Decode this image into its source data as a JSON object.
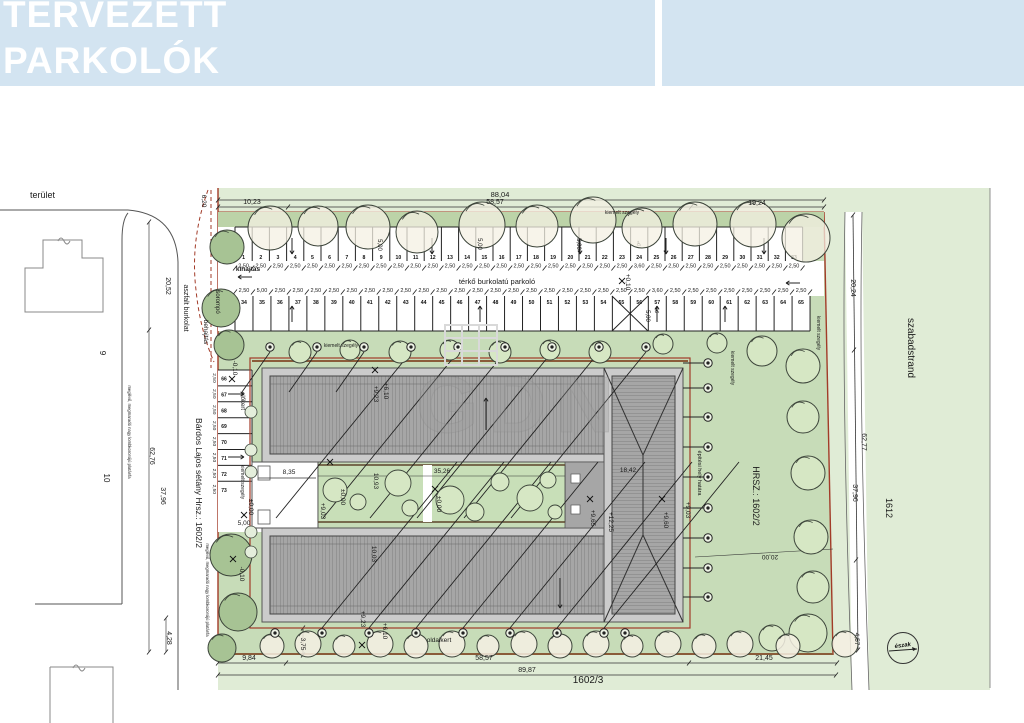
{
  "header": {
    "line1": "TERVEZETT",
    "line2": "PARKOLÓK",
    "bg_color": "#d3e4f1",
    "text_color": "#ffffff"
  },
  "watermark": {
    "text": "GDN"
  },
  "colors": {
    "site_green": "#c7dcb8",
    "strip_green": "#bcd3a8",
    "beach_green": "#e0ecd6",
    "tree_light": "#d6e7c4",
    "tree_cream": "#f4f0e3",
    "tree_dark": "#a7c394",
    "roof_gray": "#a6a6a6",
    "roof_light": "#cbcbcb",
    "hatch": "#6f6f6f",
    "boundary_red": "#a23b28",
    "curb_brown": "#8a5c3a",
    "line_dark": "#222222",
    "building_outline": "#888888"
  },
  "parking": {
    "aisle_label": "térkő burkolatú parkoló",
    "exit_label": "kihajtás",
    "entry_label": "behajtás",
    "gate_label": "sorompó",
    "top_row": {
      "numbers": [
        "1",
        "2",
        "3",
        "4",
        "5",
        "6",
        "7",
        "8",
        "9",
        "10",
        "11",
        "12",
        "13",
        "14",
        "15",
        "16",
        "17",
        "18",
        "19",
        "20",
        "21",
        "22",
        "23",
        "24",
        "25",
        "26",
        "27",
        "28",
        "29",
        "30",
        "31",
        "32",
        "33"
      ],
      "dims": [
        "2,50",
        "2,50",
        "2,50",
        "2,50",
        "2,50",
        "2,50",
        "2,50",
        "2,50",
        "2,50",
        "2,50",
        "2,50",
        "2,50",
        "2,50",
        "2,50",
        "2,50",
        "2,50",
        "2,50",
        "2,50",
        "2,50",
        "2,50",
        "2,50",
        "2,50",
        "2,50",
        "3,60",
        "2,50",
        "2,50",
        "2,50",
        "2,50",
        "2,50",
        "2,50",
        "2,50",
        "2,50",
        "2,50"
      ]
    },
    "bottom_row": {
      "numbers": [
        "34",
        "35",
        "36",
        "37",
        "38",
        "39",
        "40",
        "41",
        "42",
        "43",
        "44",
        "45",
        "46",
        "47",
        "48",
        "49",
        "50",
        "51",
        "52",
        "53",
        "54",
        "55",
        "56",
        "57",
        "58",
        "59",
        "60",
        "61",
        "62",
        "63",
        "64",
        "65"
      ],
      "dims": [
        "2,50",
        "5,00",
        "2,50",
        "2,50",
        "2,50",
        "2,50",
        "2,50",
        "2,50",
        "2,50",
        "2,50",
        "2,50",
        "2,50",
        "2,50",
        "2,50",
        "2,50",
        "2,50",
        "2,50",
        "2,50",
        "2,50",
        "2,50",
        "2,50",
        "2,50",
        "2,50",
        "3,60",
        "2,50",
        "2,50",
        "2,50",
        "2,50",
        "2,50",
        "2,50",
        "2,50",
        "2,50"
      ]
    },
    "left_col": {
      "numbers": [
        "66",
        "67",
        "68",
        "69",
        "70",
        "71",
        "72",
        "73"
      ],
      "dims": [
        "2,50",
        "2,50",
        "2,50",
        "2,50",
        "2,50",
        "2,50",
        "2,50",
        "2,50"
      ]
    }
  },
  "annotations": [
    {
      "t": "terület",
      "x": 30,
      "y": 198,
      "r": 0,
      "s": 9,
      "a": "start"
    },
    {
      "t": "6,20",
      "x": 202,
      "y": 201,
      "r": 90,
      "s": 6.5
    },
    {
      "t": "10,23",
      "x": 252,
      "y": 204,
      "r": 0,
      "s": 7
    },
    {
      "t": "88,04",
      "x": 500,
      "y": 197,
      "r": 0,
      "s": 7.5
    },
    {
      "t": "58,57",
      "x": 495,
      "y": 204,
      "r": 0,
      "s": 7
    },
    {
      "t": "19,24",
      "x": 757,
      "y": 205,
      "r": 0,
      "s": 7
    },
    {
      "t": "kiemelt szegély",
      "x": 622,
      "y": 214,
      "r": 0,
      "s": 5
    },
    {
      "t": "kihajtás",
      "x": 248,
      "y": 271,
      "r": 0,
      "s": 6.5,
      "b": 1
    },
    {
      "t": "térkő burkolatú parkoló",
      "x": 497,
      "y": 284,
      "r": 0,
      "s": 7.5
    },
    {
      "t": "sorompó",
      "x": 216,
      "y": 302,
      "r": 90,
      "s": 6
    },
    {
      "t": "behajtás",
      "x": 204,
      "y": 332,
      "r": 90,
      "s": 6.5
    },
    {
      "t": "aszfalt burkolat",
      "x": 184,
      "y": 308,
      "r": 90,
      "s": 7
    },
    {
      "t": "20,52",
      "x": 166,
      "y": 286,
      "r": 90,
      "s": 7
    },
    {
      "t": "62,76",
      "x": 150,
      "y": 456,
      "r": 90,
      "s": 7
    },
    {
      "t": "37,96",
      "x": 161,
      "y": 496,
      "r": 90,
      "s": 7
    },
    {
      "t": "Bárdos Lajos sétány Hrsz.: 1602/2",
      "x": 196,
      "y": 483,
      "r": 90,
      "s": 8.5
    },
    {
      "t": "9",
      "x": 100,
      "y": 353,
      "r": 90,
      "s": 8
    },
    {
      "t": "10",
      "x": 104,
      "y": 478,
      "r": 90,
      "s": 8
    },
    {
      "t": "4,28",
      "x": 167,
      "y": 638,
      "r": 90,
      "s": 7
    },
    {
      "t": "-0,10",
      "x": 233,
      "y": 368,
      "r": 90,
      "s": 6.5
    },
    {
      "t": "+0,10",
      "x": 626,
      "y": 282,
      "r": 90,
      "s": 6.5
    },
    {
      "t": "5,00",
      "x": 378,
      "y": 245,
      "r": 90,
      "s": 6
    },
    {
      "t": "5,00",
      "x": 478,
      "y": 244,
      "r": 90,
      "s": 6
    },
    {
      "t": "5,00",
      "x": 577,
      "y": 244,
      "r": 90,
      "s": 6
    },
    {
      "t": "5,00",
      "x": 646,
      "y": 316,
      "r": 90,
      "s": 6
    },
    {
      "t": "előkert",
      "x": 241,
      "y": 401,
      "r": 90,
      "s": 6
    },
    {
      "t": "kiemelt szegély",
      "x": 241,
      "y": 482,
      "r": 90,
      "s": 5
    },
    {
      "t": "kiemelt szegély",
      "x": 341,
      "y": 347,
      "r": 0,
      "s": 5
    },
    {
      "t": "kiemelt szegély",
      "x": 817,
      "y": 333,
      "r": 90,
      "s": 5
    },
    {
      "t": "kiemelt szegély",
      "x": 731,
      "y": 368,
      "r": 90,
      "s": 5
    },
    {
      "t": "±0,00",
      "x": 249,
      "y": 507,
      "r": 90,
      "s": 6.5
    },
    {
      "t": "5,00",
      "x": 244,
      "y": 525,
      "r": 0,
      "s": 6.5
    },
    {
      "t": "-0,10",
      "x": 240,
      "y": 574,
      "r": 90,
      "s": 6.5
    },
    {
      "t": "8,35",
      "x": 289,
      "y": 474,
      "r": 0,
      "s": 6.5
    },
    {
      "t": "35,26",
      "x": 442,
      "y": 473,
      "r": 0,
      "s": 6.5
    },
    {
      "t": "10,93",
      "x": 374,
      "y": 481,
      "r": 90,
      "s": 6.5
    },
    {
      "t": "±0,00",
      "x": 341,
      "y": 497,
      "r": 90,
      "s": 6.5
    },
    {
      "t": "+9,03",
      "x": 321,
      "y": 511,
      "r": 90,
      "s": 6.5
    },
    {
      "t": "±0,00",
      "x": 437,
      "y": 504,
      "r": 90,
      "s": 6.5
    },
    {
      "t": "+9,23",
      "x": 374,
      "y": 394,
      "r": 90,
      "s": 6.5
    },
    {
      "t": "+6,10",
      "x": 384,
      "y": 391,
      "r": 90,
      "s": 6.5
    },
    {
      "t": "10,03",
      "x": 372,
      "y": 554,
      "r": 90,
      "s": 6.5
    },
    {
      "t": "+9,23",
      "x": 361,
      "y": 619,
      "r": 90,
      "s": 6.5
    },
    {
      "t": "+6,10",
      "x": 383,
      "y": 631,
      "r": 90,
      "s": 6.5
    },
    {
      "t": "18,42",
      "x": 628,
      "y": 472,
      "r": 0,
      "s": 6.5
    },
    {
      "t": "+9,65",
      "x": 591,
      "y": 518,
      "r": 90,
      "s": 6.5
    },
    {
      "t": "+12,25",
      "x": 609,
      "y": 522,
      "r": 90,
      "s": 6.5
    },
    {
      "t": "+9,60",
      "x": 664,
      "y": 520,
      "r": 90,
      "s": 6.5
    },
    {
      "t": "+9,03",
      "x": 686,
      "y": 510,
      "r": 90,
      "s": 6.5
    },
    {
      "t": "oldalkert",
      "x": 439,
      "y": 642,
      "r": 0,
      "s": 6.5
    },
    {
      "t": "3,75",
      "x": 301,
      "y": 644,
      "r": 90,
      "s": 6.5
    },
    {
      "t": "9,84",
      "x": 249,
      "y": 660,
      "r": 0,
      "s": 7
    },
    {
      "t": "58,57",
      "x": 484,
      "y": 660,
      "r": 0,
      "s": 7
    },
    {
      "t": "21,45",
      "x": 764,
      "y": 660,
      "r": 0,
      "s": 7
    },
    {
      "t": "89,87",
      "x": 527,
      "y": 672,
      "r": 0,
      "s": 7
    },
    {
      "t": "1602/3",
      "x": 588,
      "y": 683,
      "r": 0,
      "s": 10
    },
    {
      "t": "4,57",
      "x": 855,
      "y": 639,
      "r": 90,
      "s": 6.5
    },
    {
      "t": "20,00",
      "x": 770,
      "y": 555,
      "r": 180,
      "s": 6.5
    },
    {
      "t": "HRSZ.: 1602/2",
      "x": 753,
      "y": 496,
      "r": 90,
      "s": 9
    },
    {
      "t": "építési hely határa",
      "x": 698,
      "y": 473,
      "r": 90,
      "s": 5.5
    },
    {
      "t": "szabadstrand",
      "x": 908,
      "y": 348,
      "r": 90,
      "s": 10
    },
    {
      "t": "1612",
      "x": 886,
      "y": 508,
      "r": 90,
      "s": 9
    },
    {
      "t": "20,24",
      "x": 851,
      "y": 288,
      "r": 90,
      "s": 7
    },
    {
      "t": "62,77",
      "x": 862,
      "y": 442,
      "r": 90,
      "s": 7
    },
    {
      "t": "37,96",
      "x": 853,
      "y": 493,
      "r": 90,
      "s": 7
    },
    {
      "t": "meglévő, megmaradó nagy lombkoronájú platánfa",
      "x": 128,
      "y": 432,
      "r": 90,
      "s": 4.2
    },
    {
      "t": "meglévő, megmaradó nagy lombkoronájú platánfa",
      "x": 206,
      "y": 590,
      "r": 90,
      "s": 4.2
    }
  ],
  "north": {
    "label": "észak",
    "x": 903,
    "y": 648,
    "r": 15.5
  },
  "trees": {
    "edge_top": [
      [
        270,
        228,
        22
      ],
      [
        318,
        226,
        20
      ],
      [
        368,
        227,
        22
      ],
      [
        417,
        232,
        21
      ],
      [
        482,
        225,
        23
      ],
      [
        537,
        226,
        21
      ],
      [
        593,
        220,
        23
      ],
      [
        642,
        228,
        20
      ],
      [
        695,
        224,
        22
      ],
      [
        753,
        224,
        23
      ],
      [
        806,
        238,
        24
      ]
    ],
    "left_dark": [
      [
        227,
        247,
        17
      ],
      [
        221,
        308,
        19
      ],
      [
        229,
        345,
        15
      ],
      [
        231,
        555,
        21
      ],
      [
        238,
        612,
        19
      ],
      [
        222,
        648,
        14
      ]
    ],
    "strip": [
      [
        300,
        352,
        11
      ],
      [
        350,
        350,
        10
      ],
      [
        400,
        352,
        11
      ],
      [
        450,
        350,
        10
      ],
      [
        500,
        352,
        11
      ],
      [
        550,
        350,
        10
      ],
      [
        600,
        352,
        11
      ],
      [
        663,
        344,
        10
      ],
      [
        717,
        343,
        10
      ],
      [
        762,
        351,
        15
      ],
      [
        803,
        366,
        17
      ]
    ],
    "right": [
      [
        803,
        417,
        16
      ],
      [
        808,
        473,
        17
      ],
      [
        811,
        537,
        17
      ],
      [
        813,
        587,
        16
      ],
      [
        808,
        633,
        19
      ],
      [
        772,
        638,
        13
      ]
    ],
    "bottom": [
      [
        272,
        646,
        12
      ],
      [
        308,
        644,
        13
      ],
      [
        344,
        646,
        11
      ],
      [
        380,
        644,
        13
      ],
      [
        416,
        646,
        12
      ],
      [
        452,
        644,
        13
      ],
      [
        488,
        646,
        11
      ],
      [
        524,
        644,
        13
      ],
      [
        560,
        646,
        12
      ],
      [
        596,
        644,
        13
      ],
      [
        632,
        646,
        11
      ],
      [
        668,
        644,
        13
      ],
      [
        704,
        646,
        12
      ],
      [
        740,
        644,
        13
      ],
      [
        788,
        646,
        12
      ],
      [
        845,
        644,
        13
      ]
    ],
    "courtyard": [
      [
        335,
        490,
        12
      ],
      [
        358,
        502,
        8
      ],
      [
        398,
        483,
        13
      ],
      [
        410,
        508,
        8
      ],
      [
        450,
        500,
        14
      ],
      [
        475,
        512,
        9
      ],
      [
        500,
        482,
        9
      ],
      [
        530,
        498,
        13
      ],
      [
        548,
        480,
        8
      ],
      [
        555,
        512,
        7
      ]
    ],
    "bushes": [
      [
        251,
        412,
        6
      ],
      [
        251,
        450,
        6
      ],
      [
        251,
        472,
        6
      ],
      [
        251,
        532,
        6
      ],
      [
        251,
        552,
        6
      ]
    ]
  },
  "lights": {
    "top": {
      "y": 347,
      "xs": [
        270,
        317,
        364,
        411,
        458,
        505,
        552,
        599,
        646
      ]
    },
    "bottom": {
      "y": 633,
      "xs": [
        275,
        322,
        369,
        416,
        463,
        510,
        557,
        604,
        625
      ]
    },
    "right": {
      "x": 708,
      "ys": [
        363,
        388,
        417,
        447,
        477,
        508,
        538,
        568,
        597
      ]
    }
  },
  "crosses": [
    [
      232,
      379
    ],
    [
      244,
      515
    ],
    [
      233,
      559
    ],
    [
      622,
      281
    ],
    [
      375,
      370
    ],
    [
      362,
      645
    ],
    [
      590,
      499
    ],
    [
      662,
      499
    ],
    [
      435,
      489
    ],
    [
      330,
      462
    ]
  ]
}
